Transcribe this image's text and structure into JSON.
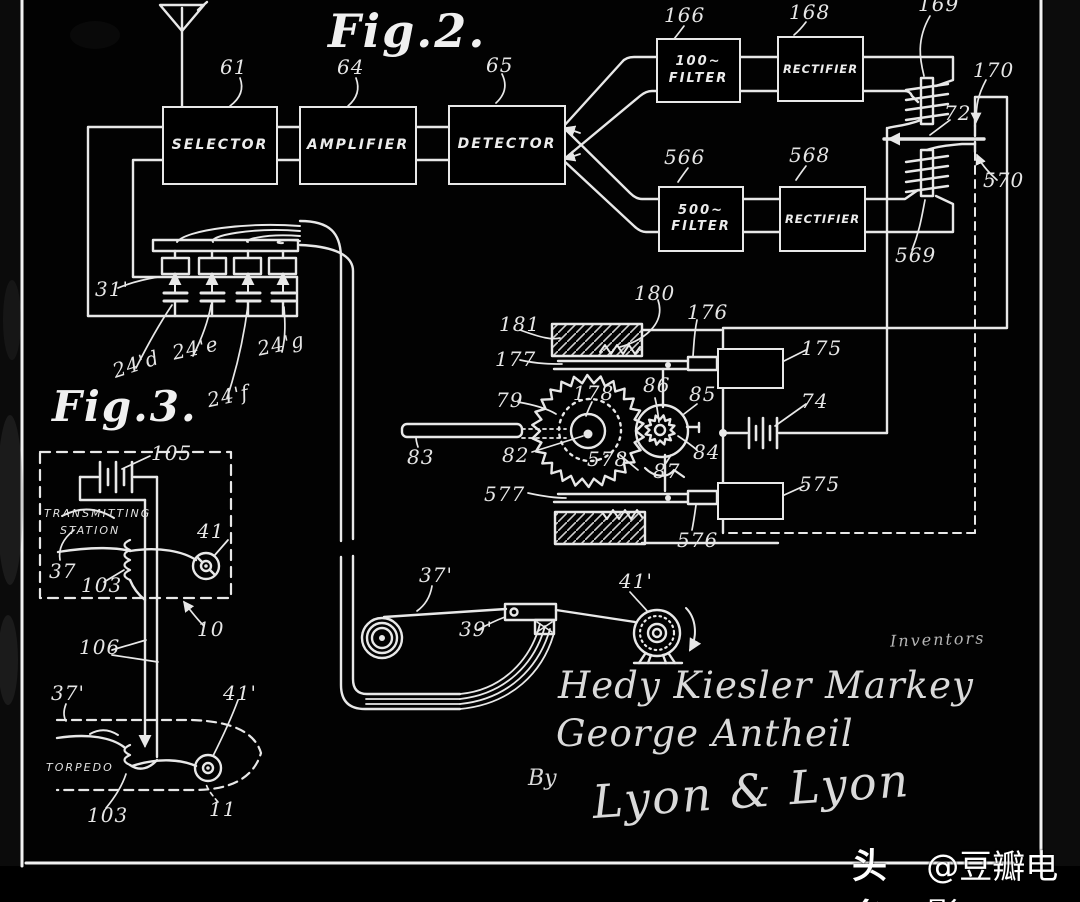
{
  "page": {
    "background": "#000000",
    "ink": "#e8e8e8",
    "description": "Patent drawing (white ink on black), frequency-hopping secret communication system"
  },
  "fig2": {
    "title": "Fig.2.",
    "boxes": {
      "selector": {
        "ref": "61",
        "label": "SELECTOR"
      },
      "amplifier": {
        "ref": "64",
        "label": "AMPLIFIER"
      },
      "detector": {
        "ref": "65",
        "label": "DETECTOR"
      },
      "filter100": {
        "ref": "166",
        "line1": "100~",
        "line2": "FILTER"
      },
      "rectifier1": {
        "ref": "168",
        "label": "RECTIFIER"
      },
      "filter500": {
        "ref": "566",
        "line1": "500~",
        "line2": "FILTER"
      },
      "rectifier2": {
        "ref": "568",
        "label": "RECTIFIER"
      }
    },
    "refs": {
      "coil_top": "169",
      "contact_top": "170",
      "armature": "72",
      "contact_bottom": "570",
      "coil_bottom": "569",
      "bank": "31'",
      "cap_d": "24'd",
      "cap_e": "24'e",
      "cap_f": "24'f",
      "cap_g": "24'g",
      "spring_top": "180",
      "stop_top": "181",
      "rack_top": "177",
      "plunger_top": "176",
      "magnet_top": "175",
      "battery": "74",
      "ratchet_wheel": "79",
      "pitch_circle": "178",
      "pinion_arm": "86",
      "pinion_ring": "85",
      "pinion": "84",
      "pawl": "87",
      "hub": "82",
      "shaft": "83",
      "wheel_rim": "578",
      "rack_bottom": "577",
      "plunger_bottom": "576",
      "magnet_bottom": "575",
      "tape": "37'",
      "head": "39'",
      "reel": "41'"
    }
  },
  "fig3": {
    "title": "Fig.3.",
    "station": {
      "line1": "TRANSMITTING",
      "line2": "STATION"
    },
    "torpedo_label": "TORPEDO",
    "refs": {
      "battery": "105",
      "key": "37",
      "coil": "103",
      "reel": "41",
      "station_pointer": "10",
      "conductors": "106",
      "tape": "37'",
      "torpedo_coil": "103",
      "torpedo_pointer": "11",
      "torpedo_reel": "41'"
    }
  },
  "signatures": {
    "inventors": "Inventors",
    "name1": "Hedy Kiesler Markey",
    "name2": "George Antheil",
    "by": "By",
    "firm": "Lyon & Lyon"
  },
  "watermark": {
    "brand": "头条",
    "account": "@豆瓣电影"
  }
}
